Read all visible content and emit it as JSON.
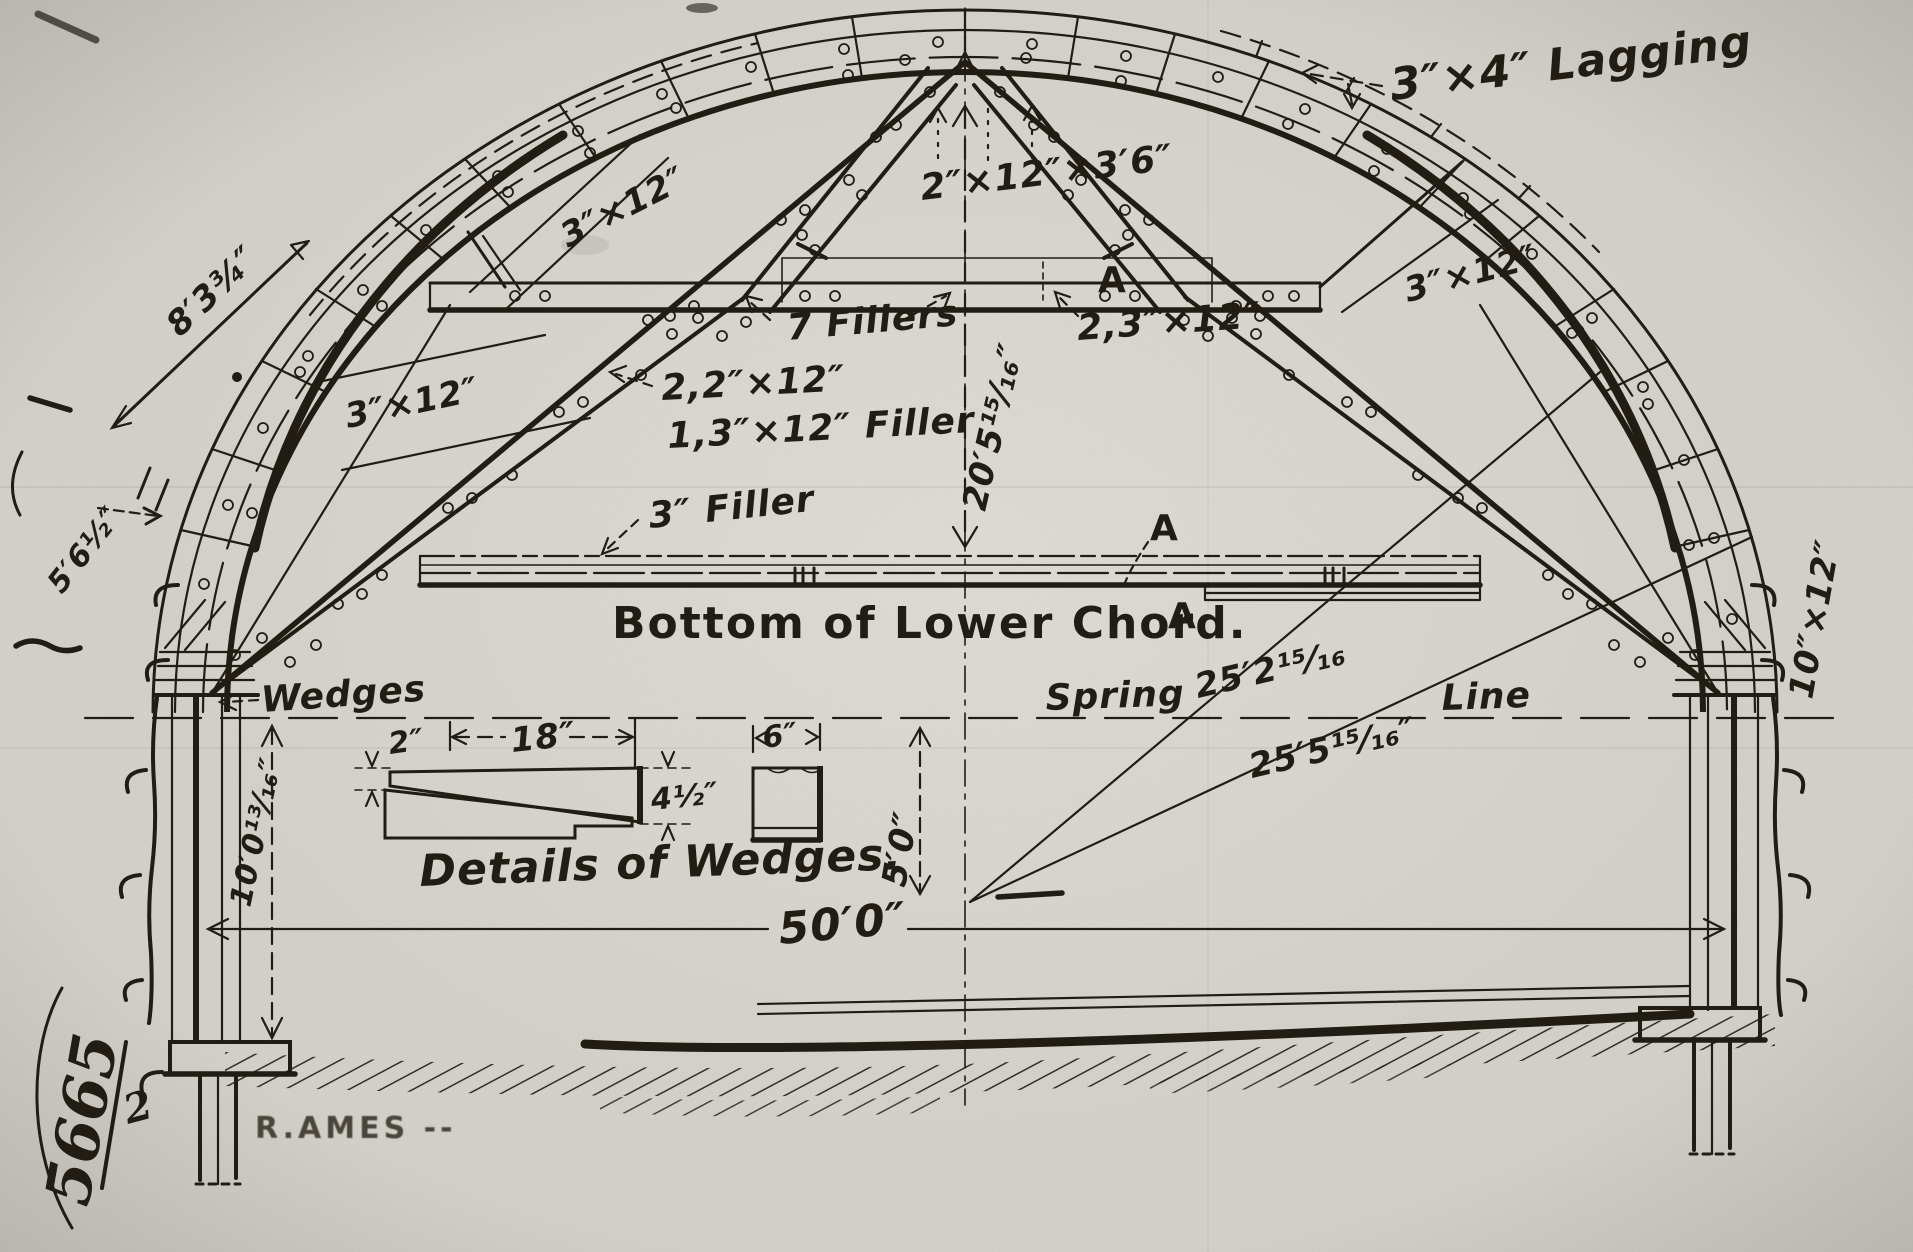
{
  "drawing": {
    "paper_color": "#d6d3cc",
    "ink_color": "#211d15",
    "labels": {
      "lagging": "3″×4″ Lagging",
      "apex_brace": "2″×12″×3′6″",
      "plank_upper_left": "3″×12″",
      "plank_mid_left": "3″×12″",
      "plank_right": "3″×12″",
      "fillers": "7 Fillers",
      "chord_planks": "2,3″×12″",
      "diagonal_planks": "2,2″×12″",
      "diagonal_filler": "1,3″×12″ Filler",
      "filler3": "3″ Filler",
      "bottom_chord_caption": "Bottom of Lower Chord.",
      "wedges": "Wedges",
      "wedge_detail_caption": "Details of Wedges.",
      "spring": "Spring",
      "line": "Line",
      "section_a_chord": "A",
      "section_a_strip_top": "A",
      "section_a_strip_bottom": "A"
    },
    "dimensions": {
      "rise": "20′5¹⁵⁄₁₆″",
      "radius_inner": "25′2¹⁵⁄₁₆",
      "radius_outer": "25′5¹⁵⁄₁₆″",
      "center_drop": "5′0″",
      "span": "50′0″",
      "post_height": "10′0¹³⁄₁₆″",
      "post_section": "10″×12″",
      "arc_upper": "8′3¾″",
      "arc_lower": "5′6½″",
      "wedge_thin_end": "2″",
      "wedge_length": "18″",
      "wedge_width": "6″",
      "wedge_thick_end": "4½″"
    },
    "annotations": {
      "sheet_number": "5665",
      "sheet_denominator": "2",
      "stamp": "R.AMES --"
    }
  }
}
